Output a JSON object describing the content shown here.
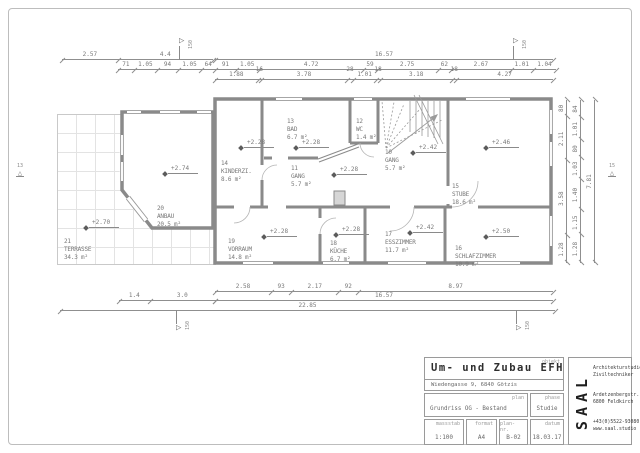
{
  "plan": {
    "rooms": [
      {
        "num": "21",
        "name": "TERRASSE",
        "area": "34.3 m²",
        "level": "+2.70"
      },
      {
        "num": "20",
        "name": "ANBAU",
        "area": "20.5 m²",
        "level": "+2.74"
      },
      {
        "num": "14",
        "name": "KINDERZI.",
        "area": "8.6 m²",
        "level": "+2.28"
      },
      {
        "num": "13",
        "name": "BAD",
        "area": "6.7 m²",
        "level": "+2.28"
      },
      {
        "num": "12",
        "name": "WC",
        "area": "1.4 m²"
      },
      {
        "num": "11",
        "name": "GANG",
        "area": "5.7 m²",
        "level": "+2.28"
      },
      {
        "num": "10",
        "name": "GANG",
        "area": "5.7 m²",
        "level": "+2.42"
      },
      {
        "num": "15",
        "name": "STUBE",
        "area": "18.6 m²",
        "level": "+2.46"
      },
      {
        "num": "19",
        "name": "VORRAUM",
        "area": "14.8 m²",
        "level": "+2.28"
      },
      {
        "num": "18",
        "name": "KÜCHE",
        "area": "6.7 m²",
        "level": "+2.28"
      },
      {
        "num": "17",
        "name": "ESSZIMMER",
        "area": "11.7 m²",
        "level": "+2.42"
      },
      {
        "num": "16",
        "name": "SCHLAFZIMMER",
        "area": "10.9 m²",
        "level": "+2.50"
      }
    ]
  },
  "dims": {
    "top1l": [
      "2.57",
      "4.4"
    ],
    "top1r": [
      "16.57"
    ],
    "top2": [
      "71",
      "1.05",
      "94",
      "1.05",
      "64",
      "91",
      "1.05",
      "4.72",
      "59",
      "2.75",
      "62",
      "2.67",
      "1.01",
      "1.04"
    ],
    "top3": [
      "1.88",
      "16",
      "3.78",
      "28",
      "1.01",
      "18",
      "3.18",
      "18",
      "4.27"
    ],
    "bot1": [
      "2.58",
      "93",
      "2.17",
      "92",
      "8.97"
    ],
    "bot2l": [
      "1.4",
      "3.0"
    ],
    "bot2r": [
      "16.57"
    ],
    "bot3": [
      "22.85"
    ],
    "right1": [
      "1.28",
      "3.58",
      "2.11",
      "80"
    ],
    "right2": [
      "1.28",
      "1.15",
      "1.40",
      "1.03",
      "80",
      "1.01",
      "84"
    ],
    "right3": [
      "7.81"
    ]
  },
  "markers": {
    "left_section": "13",
    "right_section": "15",
    "flag_label": "150"
  },
  "titleblock": {
    "objekt_label": "objekt",
    "title": "Um- und Zubau EFH",
    "address": "Wiedengasse 9, 6840 Götzis",
    "plan_label": "plan",
    "plan_value": "Grundriss OG - Bestand",
    "phase_label": "phase",
    "phase_value": "Studie",
    "massstab_label": "massstab",
    "massstab_value": "1:100",
    "format_label": "format",
    "format_value": "A4",
    "plannr_label": "plan-nr.",
    "plannr_value": "B-02",
    "datum_label": "datum",
    "datum_value": "18.03.17",
    "logo": "SAAL",
    "firm_line1": "Architekturstudio",
    "firm_line2": "Ziviltechniker",
    "addr_line1": "Ardetzenbergstr. 51-4",
    "addr_line2": "6800 Feldkirch",
    "tel": "+43(0)5522-93080",
    "web": "www.saal.studio"
  }
}
